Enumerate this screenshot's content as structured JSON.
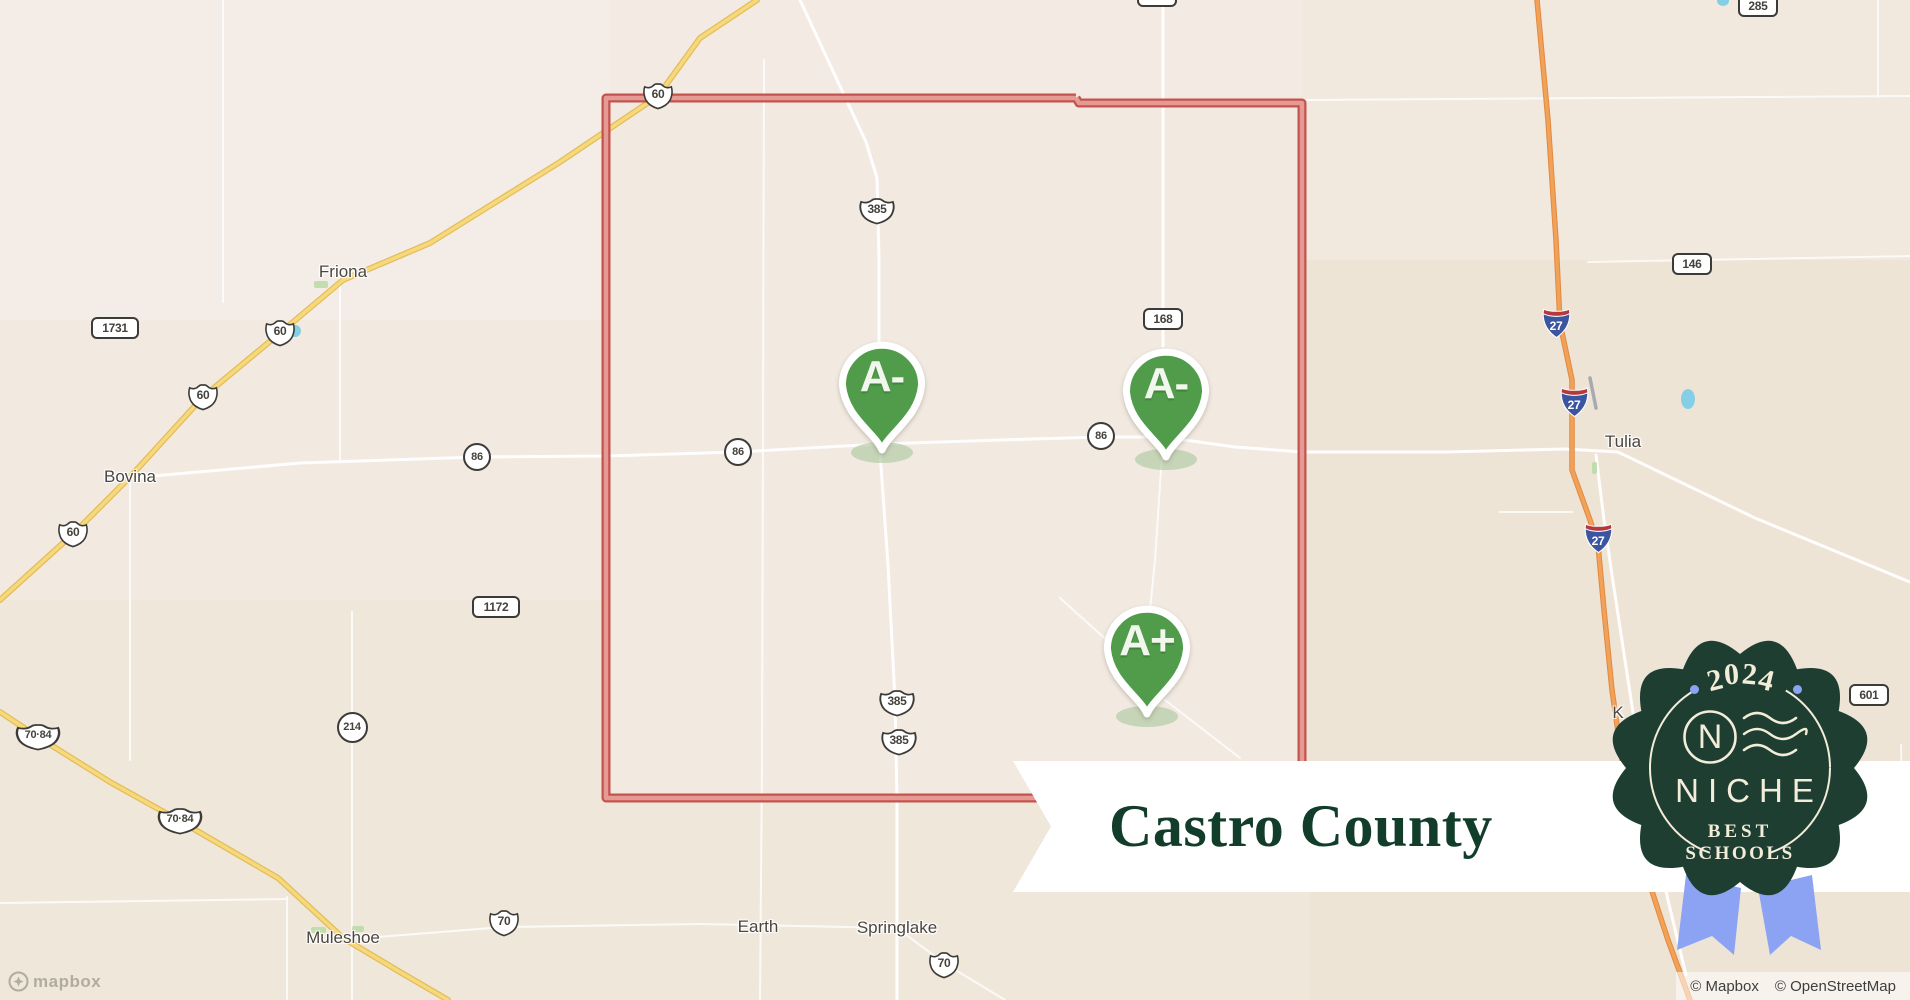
{
  "banner": {
    "title": "Castro County"
  },
  "badge": {
    "year": "2024",
    "brand": "NICHE",
    "subtitle_line1": "BEST",
    "subtitle_line2": "SCHOOLS"
  },
  "attribution": {
    "items": [
      "© Mapbox",
      "© OpenStreetMap"
    ]
  },
  "logo": {
    "text": "mapbox"
  },
  "markers": [
    {
      "grade": "A-",
      "x": 882,
      "y": 383
    },
    {
      "grade": "A-",
      "x": 1166,
      "y": 390
    },
    {
      "grade": "A+",
      "x": 1147,
      "y": 647
    }
  ],
  "towns": [
    {
      "name": "Friona",
      "x": 343,
      "y": 272
    },
    {
      "name": "Bovina",
      "x": 130,
      "y": 477
    },
    {
      "name": "Tulia",
      "x": 1623,
      "y": 442
    },
    {
      "name": "Muleshoe",
      "x": 343,
      "y": 938
    },
    {
      "name": "Earth",
      "x": 758,
      "y": 927
    },
    {
      "name": "Springlake",
      "x": 897,
      "y": 928
    },
    {
      "name": "K",
      "x": 1618,
      "y": 713
    }
  ],
  "shields": [
    {
      "type": "us",
      "label": "60",
      "x": 658,
      "y": 96
    },
    {
      "type": "us",
      "label": "60",
      "x": 280,
      "y": 333
    },
    {
      "type": "us",
      "label": "60",
      "x": 203,
      "y": 397
    },
    {
      "type": "us",
      "label": "60",
      "x": 73,
      "y": 534
    },
    {
      "type": "us",
      "label": "70·84",
      "x": 38,
      "y": 737
    },
    {
      "type": "us",
      "label": "70·84",
      "x": 180,
      "y": 821
    },
    {
      "type": "us",
      "label": "385",
      "x": 877,
      "y": 211
    },
    {
      "type": "us",
      "label": "385",
      "x": 897,
      "y": 703
    },
    {
      "type": "us",
      "label": "385",
      "x": 899,
      "y": 742
    },
    {
      "type": "us",
      "label": "70",
      "x": 504,
      "y": 923
    },
    {
      "type": "us",
      "label": "70",
      "x": 944,
      "y": 965
    },
    {
      "type": "circle",
      "label": "86",
      "x": 477,
      "y": 457
    },
    {
      "type": "circle",
      "label": "86",
      "x": 738,
      "y": 452
    },
    {
      "type": "circle",
      "label": "86",
      "x": 1101,
      "y": 436
    },
    {
      "type": "circle",
      "label": "214",
      "x": 352,
      "y": 727
    },
    {
      "type": "rect",
      "label": "1731",
      "x": 115,
      "y": 328
    },
    {
      "type": "rect",
      "label": "1172",
      "x": 496,
      "y": 607
    },
    {
      "type": "rect",
      "label": "168",
      "x": 1163,
      "y": 319
    },
    {
      "type": "rect",
      "label": "168",
      "x": 1157,
      "y": -4
    },
    {
      "type": "rect",
      "label": "146",
      "x": 1692,
      "y": 264
    },
    {
      "type": "rect",
      "label": "285",
      "x": 1758,
      "y": 6
    },
    {
      "type": "rect",
      "label": "601",
      "x": 1869,
      "y": 695
    },
    {
      "type": "i27",
      "label": "27",
      "x": 1556,
      "y": 323
    },
    {
      "type": "i27",
      "label": "27",
      "x": 1574,
      "y": 402
    },
    {
      "type": "i27",
      "label": "27",
      "x": 1598,
      "y": 538
    }
  ],
  "colors": {
    "map_bg": "#f2e9e1",
    "road_white": "#ffffff",
    "road_yellow": "#f6d87d",
    "road_yellow_casing": "#e3bd58",
    "road_orange": "#f2a159",
    "road_orange_casing": "#e18a40",
    "boundary_red_casing": "#c4534e",
    "boundary_red_fill": "#e59a93",
    "marker_green": "#519c4b",
    "badge_green": "#1e3e32",
    "badge_cream": "#f2ecd9",
    "ribbon_blue": "#8ca3f3",
    "banner_text_green": "#123d2b",
    "water_blue": "#84cfe5",
    "park_green": "#b9dba5"
  }
}
